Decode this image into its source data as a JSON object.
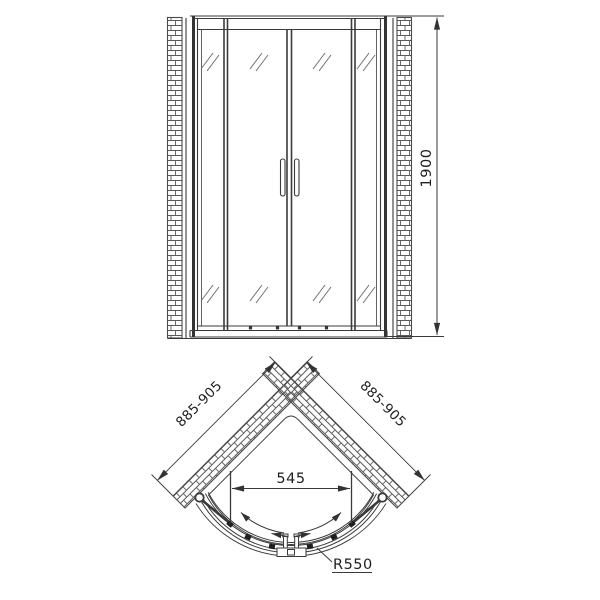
{
  "front_view": {
    "height_dimension": "1900"
  },
  "plan_view": {
    "left_wall_dimension": "885-905",
    "right_wall_dimension": "885-905",
    "opening_dimension": "545",
    "radius_dimension": "R550"
  },
  "colors": {
    "line": "#3a3a3a",
    "thin_line": "#787878",
    "hatch": "#5a5a5a",
    "text": "#1f1f1f",
    "background": "#ffffff"
  }
}
